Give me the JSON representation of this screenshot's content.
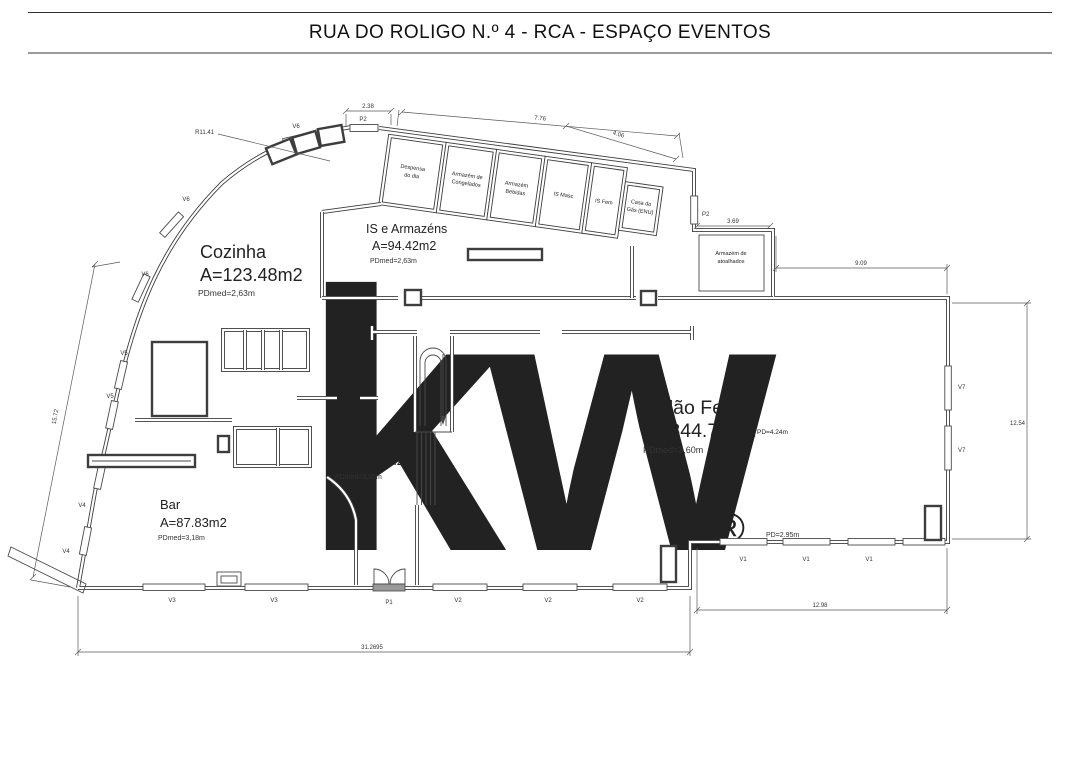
{
  "title": "RUA DO ROLIGO N.º 4 - RCA - ESPAÇO EVENTOS",
  "watermark": {
    "logo": "kw",
    "registered": "®"
  },
  "rooms": {
    "cozinha": {
      "name": "Cozinha",
      "area": "A=123.48m2",
      "pd": "PDmed=2,63m"
    },
    "is_armazens": {
      "name": "IS e Armazéns",
      "area": "A=94.42m2",
      "pd": "PDmed=2,63m"
    },
    "rececao": {
      "name": "Receção",
      "area": "A=81.44m2",
      "pd": "PDmed=3,85m"
    },
    "bar": {
      "name": "Bar",
      "area": "A=87.83m2",
      "pd": "PDmed=3,18m"
    },
    "salao": {
      "name": "Salão Festas",
      "area": "A=344.77m2",
      "pd": "PDmed=3,60m",
      "pd_right": "PD=4.24m",
      "pd_bottom": "PD=2.95m"
    }
  },
  "storage": {
    "despensa": {
      "l1": "Despensa",
      "l2": "do dia"
    },
    "congelados": {
      "l1": "Armazém de",
      "l2": "Congelados"
    },
    "bebidas": {
      "l1": "Armazém",
      "l2": "Bebidas"
    },
    "is_masc": {
      "l1": "IS Masc"
    },
    "is_fem": {
      "l1": "IS Fem"
    },
    "gas": {
      "l1": "Casa do",
      "l2": "Gás (ENU)"
    },
    "atoalhados": {
      "l1": "Armazém de",
      "l2": "atoalhados"
    }
  },
  "dims": {
    "top_left": "2.38",
    "top_mid": "7.76",
    "top_right": "4.06",
    "atoalhados_w": "3.69",
    "salao_top": "9.09",
    "salao_right": "12.54",
    "left_wall": "15.72",
    "bottom_total": "31.2695",
    "bottom_right": "12.98",
    "radius": "R11.41",
    "plus": "+"
  },
  "openings": {
    "p1": "P1",
    "p2": "P2",
    "v1": "V1",
    "v2": "V2",
    "v3": "V3",
    "v4": "V4",
    "v5": "V5",
    "v6": "V6",
    "v7": "V7"
  }
}
